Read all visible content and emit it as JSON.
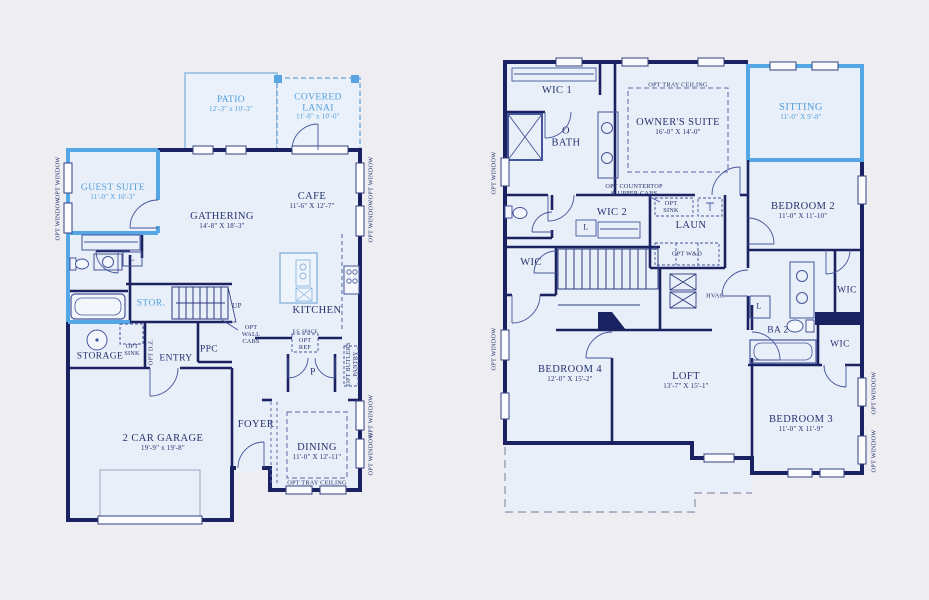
{
  "colors": {
    "background": "#EDEDF2",
    "floor_fill": "#E9EFF8",
    "wall": "#1B2262",
    "highlight_blue": "#54A6E4",
    "label_navy": "#25316E",
    "label_blue": "#4F9FDE"
  },
  "shared": {
    "opt_window": "OPT WINDOW",
    "opt_tray_ceiling": "OPT TRAY CEILING",
    "opt_sink": "OPT SINK",
    "linen": "L",
    "wic": "WIC"
  },
  "first_floor": {
    "patio_name": "PATIO",
    "patio_dims": "12'-3\" x 10'-3\"",
    "lanai_name": "COVERED LANAI",
    "lanai_dims": "11'-8\" x 10'-0\"",
    "guest_name": "GUEST SUITE",
    "guest_dims": "11'-0\" X 10'-3\"",
    "gathering_name": "GATHERING",
    "gathering_dims": "14'-8\" X 18'-3\"",
    "cafe_name": "CAFE",
    "cafe_dims": "11'-6\" X 12'-7\"",
    "kitchen": "KITCHEN",
    "stor": "STOR.",
    "up": "UP",
    "opt_wall_cabs": "OPT WALL CABS",
    "storage": "STORAGE",
    "opt_dz": "OPT D.Z.",
    "entry": "ENTRY",
    "ppc": "PPC",
    "fs_space": "F.S. SPACE",
    "opt_ref": "OPT REF",
    "pantry": "P",
    "opt_butlers_pantry": "OPT BUTLERS PANTRY",
    "foyer": "FOYER",
    "dining_name": "DINING",
    "dining_dims": "11'-0\" X 12'-11\"",
    "garage_name": "2 CAR GARAGE",
    "garage_dims": "19'-9\" x 19'-8\""
  },
  "second_floor": {
    "wic1": "WIC 1",
    "obath": "O BATH",
    "owners_name": "OWNER'S SUITE",
    "owners_dims": "16'-0\" X 14'-0\"",
    "sitting_name": "SITTING",
    "sitting_dims": "11'-0\" X 9'-8\"",
    "bedroom2_name": "BEDROOM 2",
    "bedroom2_dims": "11'-0\" X 11'-10\"",
    "opt_countertop_1": "OPT COUNTERTOP",
    "opt_countertop_2": "& UPPER CABS",
    "wic2": "WIC 2",
    "laun": "LAUN",
    "opt_wd": "OPT W&D",
    "hvac": "HVAC",
    "ba2": "BA 2",
    "bedroom4_name": "BEDROOM 4",
    "bedroom4_dims": "12'-0\" X 15'-2\"",
    "loft_name": "LOFT",
    "loft_dims": "13'-7\" X 15'-1\"",
    "bedroom3_name": "BEDROOM 3",
    "bedroom3_dims": "11'-0\" X 11'-9\""
  }
}
